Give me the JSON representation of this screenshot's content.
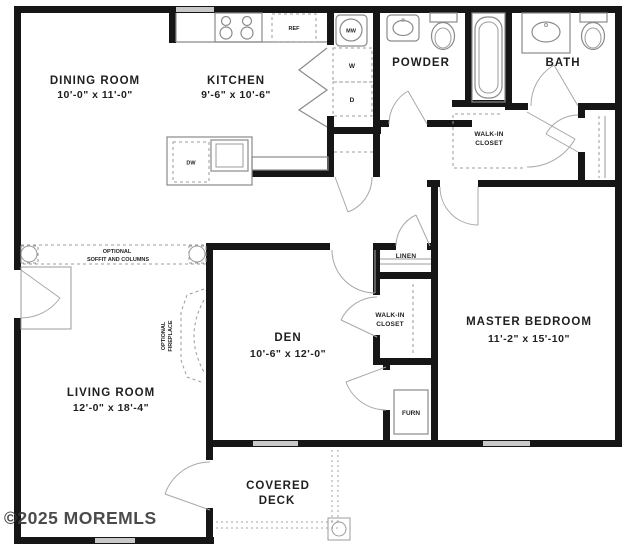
{
  "colors": {
    "wall": "#161616",
    "fixture_line": "#8a8a8a",
    "window": "#c9c9c9",
    "text": "#1f1f1f",
    "watermark": "#3c3c3c",
    "background": "#ffffff"
  },
  "rooms": {
    "dining": {
      "name": "DINING ROOM",
      "dims": "10'-0\" x 11'-0\""
    },
    "kitchen": {
      "name": "KITCHEN",
      "dims": "9'-6\" x 10'-6\""
    },
    "powder": {
      "name": "POWDER"
    },
    "bath": {
      "name": "BATH"
    },
    "walk_in_top": {
      "line1": "WALK-IN",
      "line2": "CLOSET"
    },
    "linen": {
      "name": "LINEN"
    },
    "walk_in_master": {
      "line1": "WALK-IN",
      "line2": "CLOSET"
    },
    "den": {
      "name": "DEN",
      "dims": "10'-6\" x 12'-0\""
    },
    "master": {
      "name": "MASTER BEDROOM",
      "dims": "11'-2\" x 15'-10\""
    },
    "living": {
      "name": "LIVING ROOM",
      "dims": "12'-0\" x 18'-4\""
    },
    "deck": {
      "line1": "COVERED",
      "line2": "DECK"
    }
  },
  "fixtures": {
    "refrigerator": "REF",
    "microwave": "MW",
    "washer": "W",
    "dryer": "D",
    "dishwasher": "DW",
    "furnace": "FURN"
  },
  "annotations": {
    "soffit_line1": "OPTIONAL",
    "soffit_line2": "SOFFIT AND COLUMNS",
    "fireplace_line1": "OPTIONAL",
    "fireplace_line2": "FIREPLACE"
  },
  "watermark": "©2025 MOREMLS"
}
